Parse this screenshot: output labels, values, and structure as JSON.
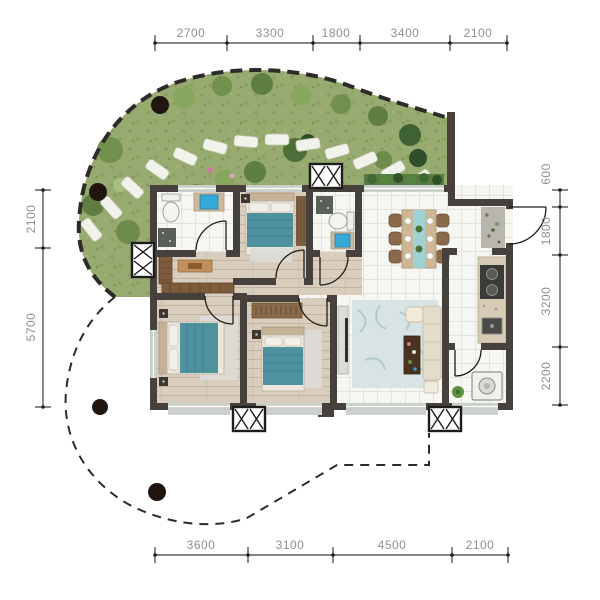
{
  "title": "apartment-floor-plan-with-garden",
  "dimensions": {
    "top": [
      "2700",
      "3300",
      "1800",
      "3400",
      "2100"
    ],
    "bottom": [
      "3600",
      "3100",
      "4500",
      "2100"
    ],
    "left": [
      "2100",
      "5700"
    ],
    "right": [
      "600",
      "1800",
      "3200",
      "2200"
    ]
  },
  "palette": {
    "wall": "#46413d",
    "wood_floor": "#d9cdbe",
    "tile_floor": "#f6f6f3",
    "garden_green": "#97aa6f",
    "bed_teal": "#4f929e",
    "basin_blue": "#35a8d8",
    "dimension_text": "#8f8f8f",
    "dimension_line": "#3c3c3c",
    "boundary_dash": "#2e2a27"
  }
}
